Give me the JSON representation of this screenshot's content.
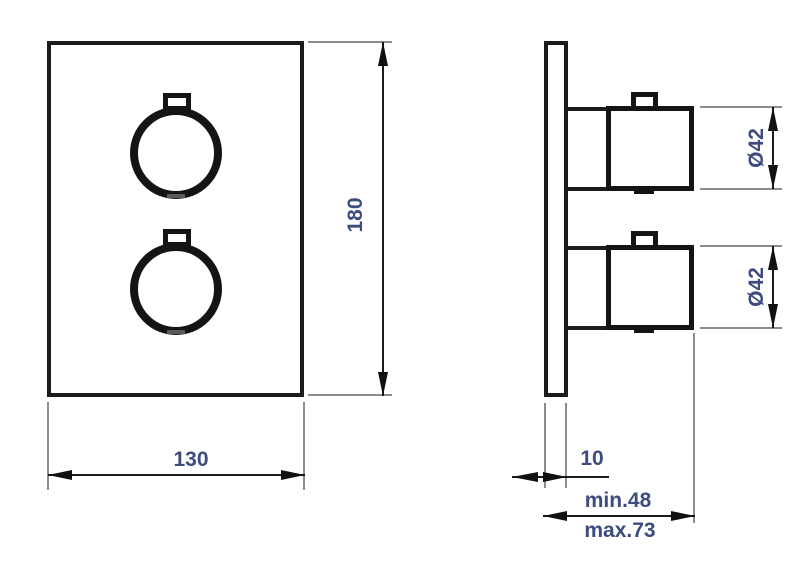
{
  "drawing": {
    "type": "technical-dimension-drawing",
    "views": {
      "front": "faceplate with two round knobs",
      "side": "wall plate profile with two knob bodies"
    },
    "dimensions": {
      "width": "130",
      "height": "180",
      "knob_top_diameter": "Ø42",
      "knob_bottom_diameter": "Ø42",
      "plate_thickness": "10",
      "depth_min": "min.48",
      "depth_max": "max.73"
    },
    "colors": {
      "object_line": "#1c1c1c",
      "extension_line": "#8c8c8c",
      "dimension_text": "#3d4b7e",
      "background": "#ffffff"
    }
  }
}
